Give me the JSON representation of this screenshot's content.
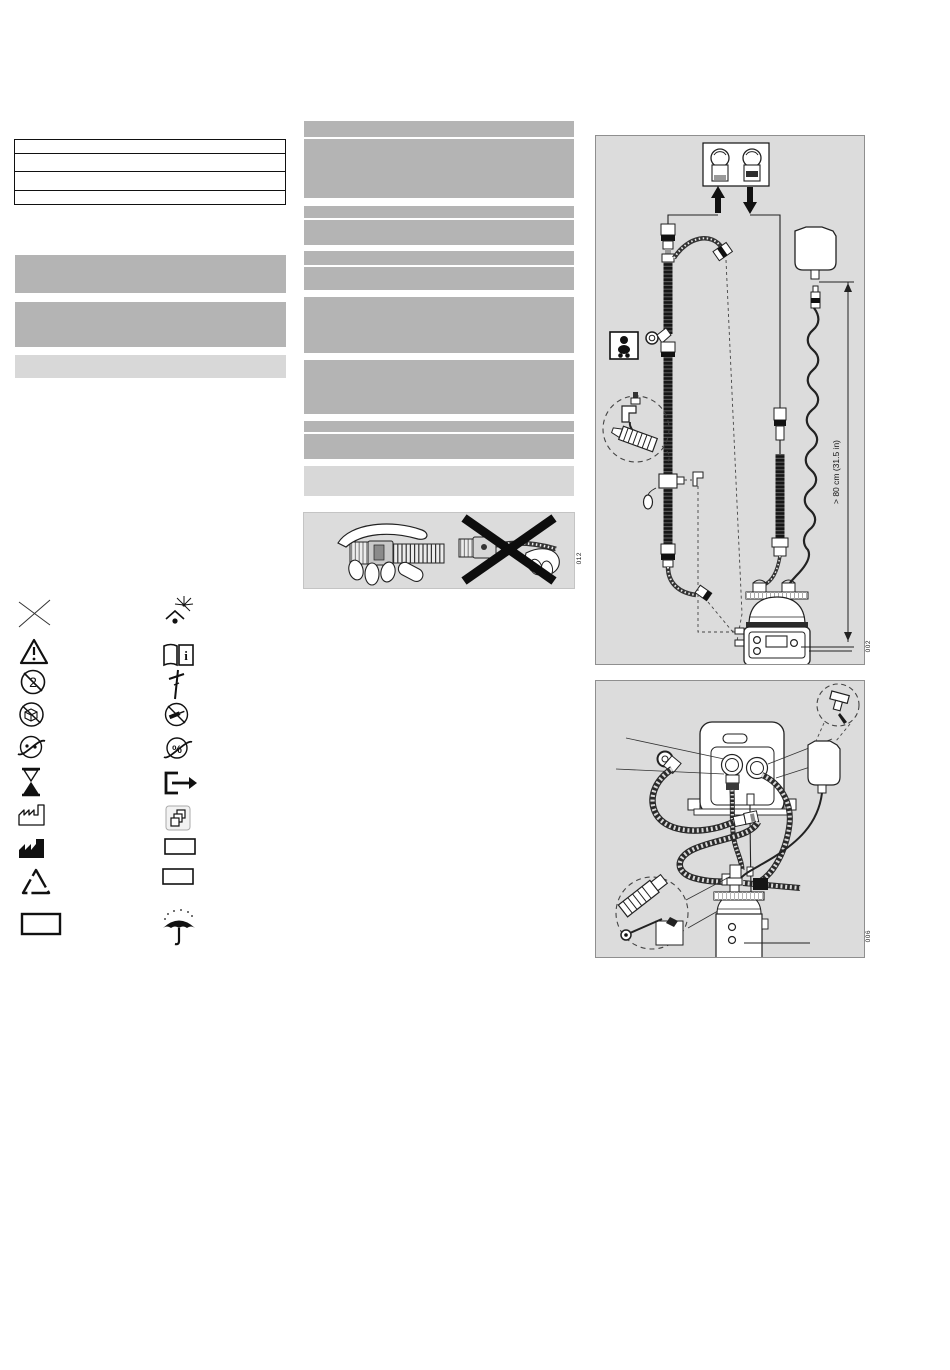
{
  "document": {
    "kind": "medical-device-instructions-page"
  },
  "colors": {
    "page_bg": "#ffffff",
    "redacted_dark": "#b4b4b4",
    "redacted_light": "#d8d8d8",
    "figure_bg": "#dcdcdc",
    "figure_border": "#8f8f8f",
    "ink": "#1a1a1a"
  },
  "info_table": {
    "row_count": 4,
    "rows": [
      "",
      "",
      "",
      ""
    ]
  },
  "figures": {
    "grip_panel": {
      "label": "012"
    },
    "circuit_diagram": {
      "label": "002",
      "dimension_text": "> 80 cm (31.5 in)"
    },
    "humidifier_diagram": {
      "label": "006"
    }
  },
  "glyphs": {
    "single_use_digit": "2",
    "percent": "%",
    "info_letter": "i"
  },
  "symbols": {
    "left_column": [
      "crossed-lines",
      "warning-triangle",
      "single-use-only",
      "crossed-circle-package",
      "crossed-circle-connector",
      "hourglass-use-by",
      "factory-outline-date-of-manufacture",
      "factory-solid-manufacturer",
      "recycling-triangle",
      "blank-box"
    ],
    "right_column": [
      "keep-away-from-sunlight",
      "consult-instructions-for-use",
      "stand-symbol",
      "crossed-circle-syringe",
      "crossed-circle-percent",
      "box-with-exit-arrow",
      "stacked-squares",
      "blank-box",
      "blank-box",
      "keep-dry-umbrella"
    ]
  }
}
